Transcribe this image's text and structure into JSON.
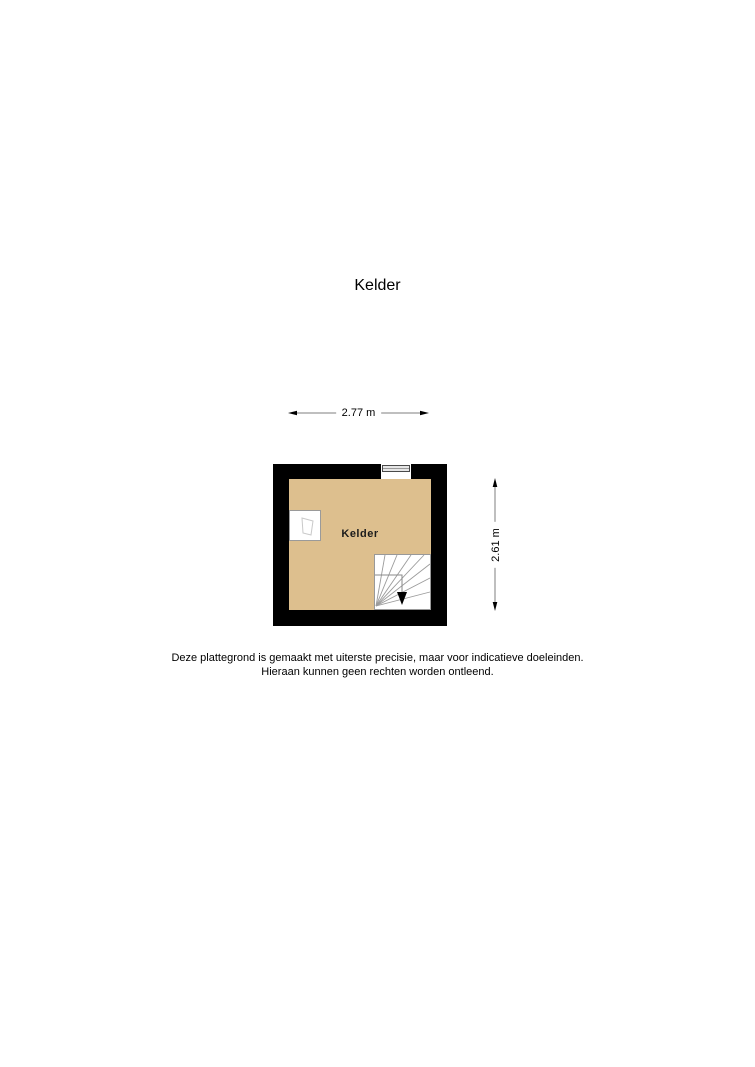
{
  "page": {
    "title": "Kelder"
  },
  "floorplan": {
    "room_label": "Kelder",
    "icons": {
      "window": "basement-window-icon",
      "stairs": "winder-stairs-down-icon",
      "fixture": "wall-niche-icon"
    },
    "colors": {
      "wall": "#000000",
      "floor": "#ddbf8e",
      "stair_outline": "#999999",
      "dimension_line": "#7f7f7f"
    }
  },
  "dimensions": {
    "width_label": "2.77 m",
    "height_label": "2.61 m"
  },
  "disclaimer": {
    "line1": "Deze plattegrond is gemaakt met uiterste precisie, maar voor indicatieve doeleinden.",
    "line2": "Hieraan kunnen geen rechten worden ontleend."
  }
}
